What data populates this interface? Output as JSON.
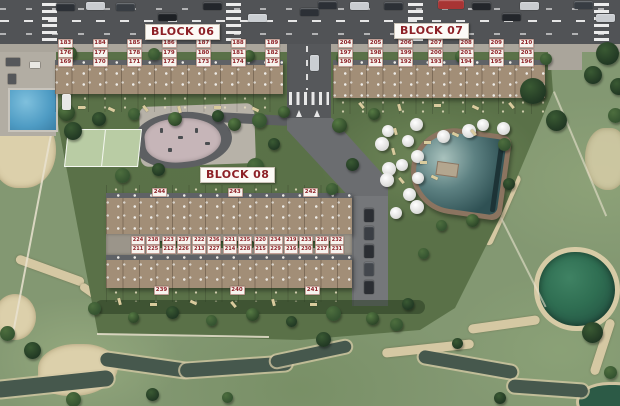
{
  "blocks": {
    "block06": {
      "title": "BLOCK 06",
      "rows": [
        [
          "183",
          "184",
          "185",
          "186",
          "187",
          "188",
          "189"
        ],
        [
          "176",
          "177",
          "178",
          "179",
          "180",
          "181",
          "182"
        ],
        [
          "169",
          "170",
          "171",
          "172",
          "173",
          "174",
          "175"
        ]
      ]
    },
    "block07": {
      "title": "BLOCK 07",
      "rows": [
        [
          "204",
          "205",
          "206",
          "207",
          "208",
          "209",
          "210"
        ],
        [
          "197",
          "198",
          "199",
          "200",
          "201",
          "202",
          "203"
        ],
        [
          "190",
          "191",
          "192",
          "193",
          "194",
          "195",
          "196"
        ]
      ]
    },
    "block08": {
      "title": "BLOCK 08",
      "top_edge_units": [
        "244",
        "243",
        "242"
      ],
      "north_pairs": [
        [
          "224",
          "238"
        ],
        [
          "223",
          "237"
        ],
        [
          "222",
          "236"
        ],
        [
          "221",
          "235"
        ],
        [
          "220",
          "234"
        ],
        [
          "219",
          "233"
        ],
        [
          "218",
          "232"
        ]
      ],
      "south_pairs": [
        [
          "211",
          "225"
        ],
        [
          "212",
          "226"
        ],
        [
          "213",
          "227"
        ],
        [
          "214",
          "228"
        ],
        [
          "215",
          "229"
        ],
        [
          "216",
          "230"
        ],
        [
          "217",
          "231"
        ]
      ],
      "bottom_edge_units": [
        "239",
        "240",
        "241"
      ]
    }
  },
  "colors": {
    "label_text": "#8d2026",
    "label_bg": "#f7f4ef",
    "site_grass": "#5a7148",
    "golf_grass": "#839872",
    "road": "#515356",
    "pool_water": "#2f5154",
    "sand": "#d5c8a3"
  }
}
